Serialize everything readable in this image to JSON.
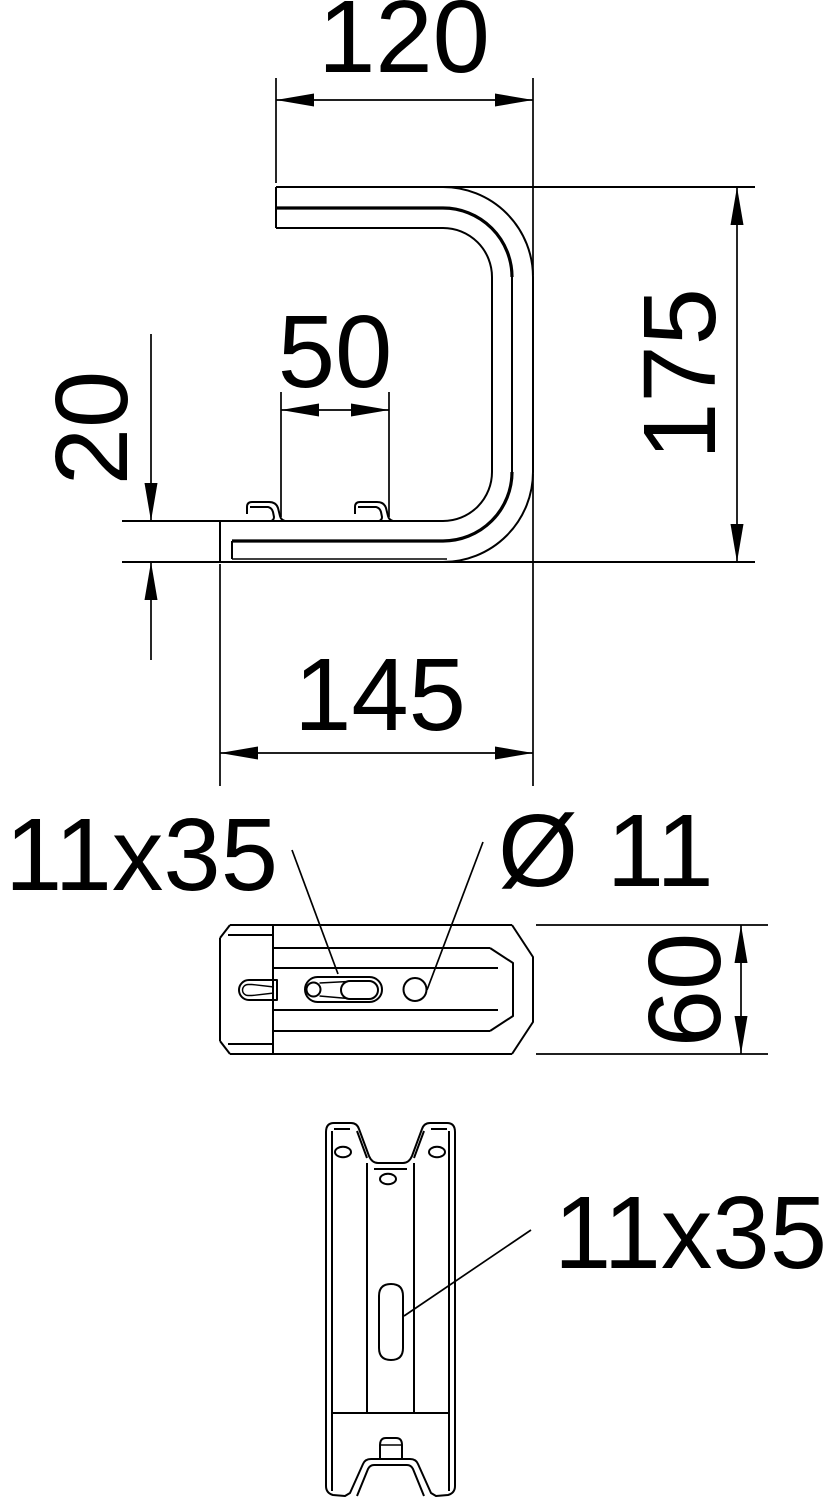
{
  "side_view": {
    "dim_top_width": "120",
    "dim_height": "175",
    "dim_hook_spacing": "50",
    "dim_flange_offset": "20",
    "dim_bottom_width": "145"
  },
  "top_view": {
    "slot_label": "11x35",
    "hole_label": "Ø 11",
    "dim_depth": "60"
  },
  "front_view": {
    "slot_label": "11x35"
  },
  "colors": {
    "line_color": "#000000",
    "background": "#ffffff"
  }
}
